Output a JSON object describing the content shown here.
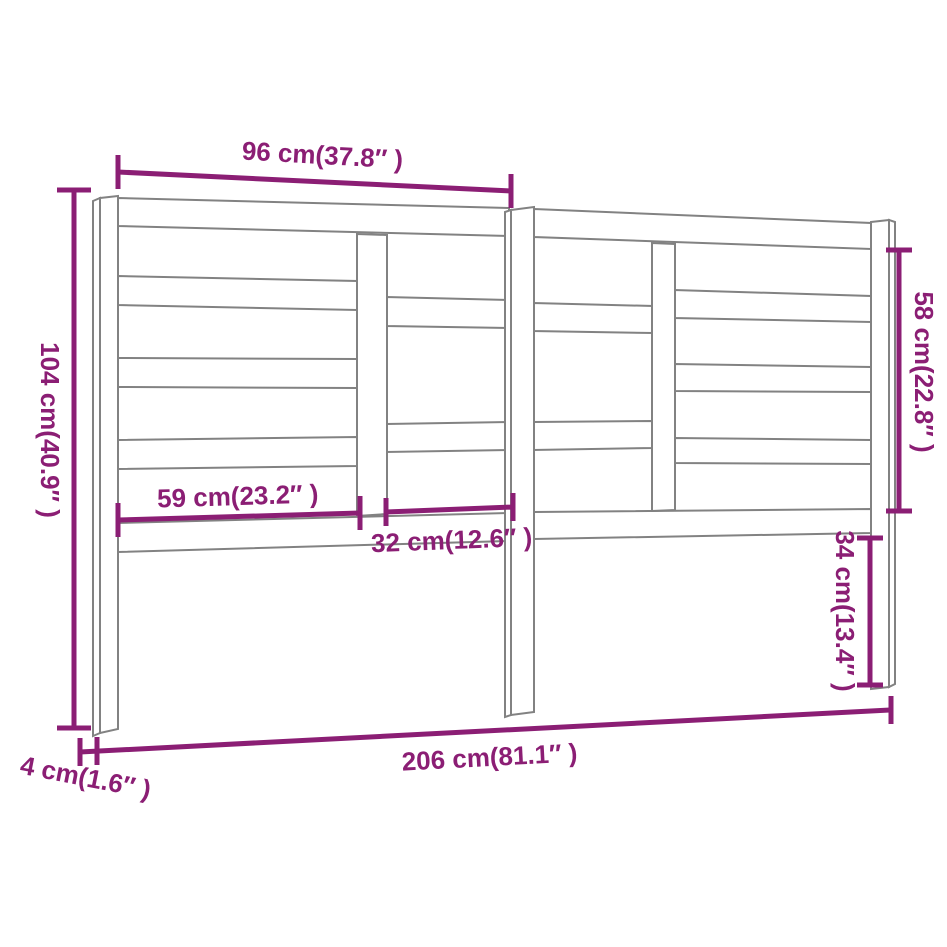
{
  "diagram": {
    "colors": {
      "dimension": "#8b1e74",
      "outline": "#828282",
      "background": "#ffffff"
    },
    "dimensions": {
      "top_width": "96 cm(37.8″ )",
      "left_height": "104 cm(40.9″ )",
      "right_upper_height": "58 cm(22.8″ )",
      "mid_left_width": "59 cm(23.2″ )",
      "mid_center_width": "32 cm(12.6″ )",
      "right_lower_height": "34 cm(13.4″ )",
      "total_width": "206 cm(81.1″ )",
      "leg_depth": "4 cm(1.6″ )"
    }
  }
}
